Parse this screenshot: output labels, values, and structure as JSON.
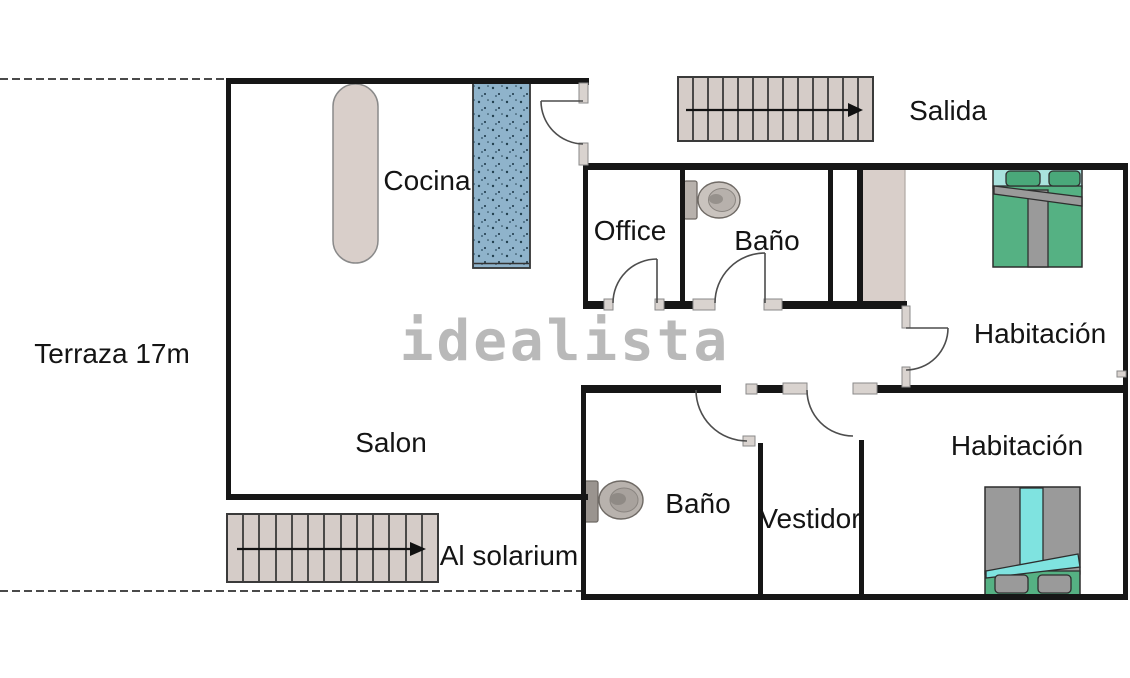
{
  "watermark": {
    "text": "idealista"
  },
  "rooms": {
    "terraza": {
      "label": "Terraza 17m"
    },
    "cocina": {
      "label": "Cocina"
    },
    "office": {
      "label": "Office"
    },
    "bano_superior": {
      "label": "Baño"
    },
    "salida": {
      "label": "Salida"
    },
    "habitacion_superior": {
      "label": "Habitación"
    },
    "salon": {
      "label": "Salon"
    },
    "al_solarium": {
      "label": "Al solarium"
    },
    "bano_inferior": {
      "label": "Baño"
    },
    "vestidor": {
      "label": "Vestidor"
    },
    "habitacion_inferior": {
      "label": "Habitación"
    }
  },
  "icons": {
    "staircase_arrow": "→",
    "staircase": "stepped-rectangle",
    "toilet": "tank-and-bowl",
    "double_bed": "mattress-with-pillows",
    "door": "quarter-circle-swing"
  },
  "colors": {
    "wall": "#161616",
    "stairs_fill": "#d5ccc8",
    "furniture_beige": "#d9cfca",
    "counter_blue": "#8fb3cb",
    "bed_green": "#55b183",
    "bed_green_dark": "#4aa87a",
    "bed_cyan_light": "#a9e2de",
    "bed_cyan": "#7fe3e0",
    "bed_gray": "#9a9a9a",
    "fixture_gray": "#c9c3be",
    "watermark_gray": "#b2b2b2"
  }
}
